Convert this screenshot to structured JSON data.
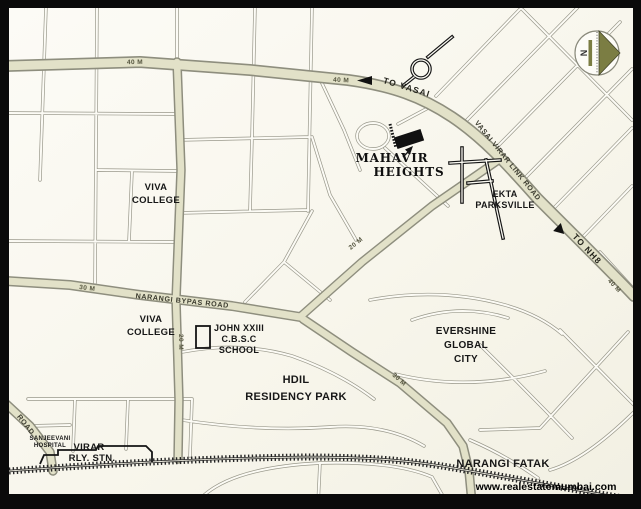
{
  "branding": {
    "watermark": "www.realestatemumbai.com"
  },
  "compass": {
    "north_label": "N"
  },
  "places": {
    "viva_college_north": {
      "line1": "VIVA",
      "line2": "COLLEGE"
    },
    "viva_college_south": {
      "line1": "VIVA",
      "line2": "COLLEGE"
    },
    "john_school": {
      "line1": "JOHN XXIII",
      "line2": "C.B.S.C",
      "line3": "SCHOOL"
    },
    "mahavir_heights": {
      "line1": "MAHAVIR",
      "line2": "HEIGHTS"
    },
    "ekta_parksville": {
      "line1": "EKTA",
      "line2": "PARKSVILLE"
    },
    "evershine_global_city": {
      "line1": "EVERSHINE",
      "line2": "GLOBAL",
      "line3": "CITY"
    },
    "hdil_residency_park": {
      "line1": "HDIL",
      "line2": "RESIDENCY PARK"
    },
    "narangi_fatak": {
      "label": "NARANGI FATAK"
    },
    "virar_station": {
      "line1": "VIRAR",
      "line2": "RLY. STN."
    },
    "sanjeevani_hospital": {
      "line1": "SANJEEVANI",
      "line2": "HOSPITAL"
    }
  },
  "roads": {
    "to_vasai": "TO VASAI",
    "to_nh8": "TO NH8",
    "vasai_virar_link_road": "VASAI VIRAR LINK ROAD",
    "narangi_bypass_road": "NARANGI BYPAS ROAD",
    "southwest_road": "ROAD",
    "width_40m_a": "40 M",
    "width_40m_b": "40 M",
    "width_40m_c": "40 M",
    "width_30m_a": "30 M",
    "width_30m_b": "30 M",
    "width_20m_a": "20 M",
    "width_20m_b": "20 M"
  },
  "colors": {
    "map_background": "#fbfaf3",
    "road_fill": "#e2e1c8",
    "road_casing": "#8e8e7e",
    "accent_olive": "#7b7d43",
    "ink": "#171717"
  }
}
